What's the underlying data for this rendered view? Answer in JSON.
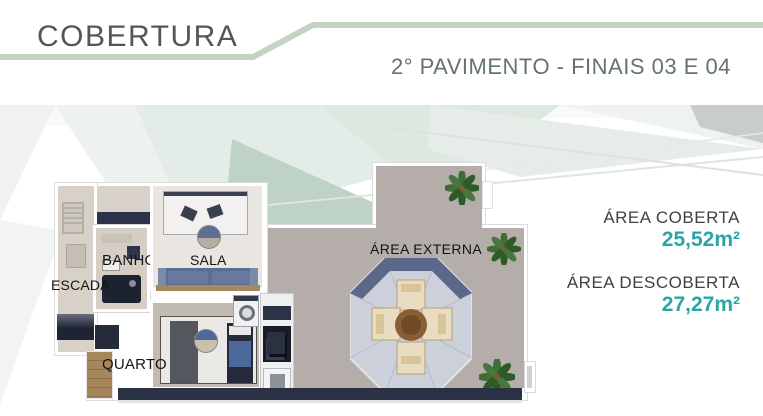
{
  "header": {
    "title": "COBERTURA",
    "subtitle": "2° PAVIMENTO - FINAIS 03 E 04"
  },
  "plan": {
    "labels": {
      "escada": "ESCADA",
      "banho": "BANHO",
      "sala": "SALA",
      "quarto": "QUARTO",
      "area_externa": "ÁREA EXTERNA"
    }
  },
  "areas": [
    {
      "label": "ÁREA COBERTA",
      "value": "25,52m²"
    },
    {
      "label": "ÁREA DESCOBERTA",
      "value": "27,27m²"
    }
  ],
  "colors": {
    "accent_teal": "#2AA5A4",
    "header_line_green": "#C3D4C4",
    "title_gray": "#54555B",
    "subtitle_green_gray": "#63756A"
  }
}
